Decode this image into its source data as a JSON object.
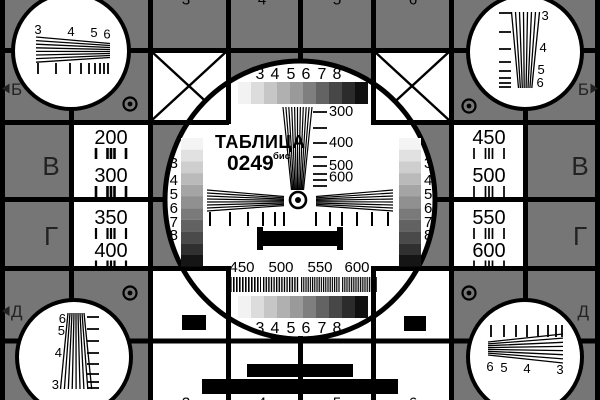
{
  "colors": {
    "background": "#767676",
    "ink": "#000000",
    "panel": "#ffffff"
  },
  "title": {
    "word": "ТАБЛИЦА",
    "number": "0249",
    "suffix": "бис"
  },
  "circle": {
    "top_scale": [
      "3",
      "4",
      "5",
      "6",
      "7",
      "8"
    ],
    "bottom_scale": [
      "3",
      "4",
      "5",
      "6",
      "7",
      "8"
    ],
    "left_steps": [
      "3",
      "4",
      "5",
      "6",
      "7",
      "8"
    ],
    "right_steps": [
      "3",
      "4",
      "5",
      "6",
      "7",
      "8"
    ],
    "freq_ticks": [
      "300",
      "400",
      "500",
      "600"
    ],
    "burst_ticks": [
      "450",
      "500",
      "550",
      "600"
    ]
  },
  "panels": {
    "left_top": [
      "200",
      "300"
    ],
    "left_bottom": [
      "350",
      "400"
    ],
    "right_top": [
      "450",
      "500"
    ],
    "right_bottom": [
      "550",
      "600"
    ]
  },
  "rows": {
    "left": [
      "Б",
      "В",
      "Г",
      "Д"
    ],
    "right": [
      "Б",
      "В",
      "Г",
      "Д"
    ]
  },
  "corners": {
    "top_left": [
      "3",
      "4",
      "5",
      "6"
    ],
    "top_right": [
      "3",
      "4",
      "5",
      "6"
    ],
    "bottom_left": [
      "6",
      "5",
      "4",
      "3"
    ],
    "bottom_right": [
      "6",
      "5",
      "4",
      "3"
    ]
  },
  "edge_numbers": {
    "top": [
      "3",
      "4",
      "5",
      "6"
    ],
    "bottom": [
      "3",
      "4",
      "5",
      "6"
    ]
  }
}
